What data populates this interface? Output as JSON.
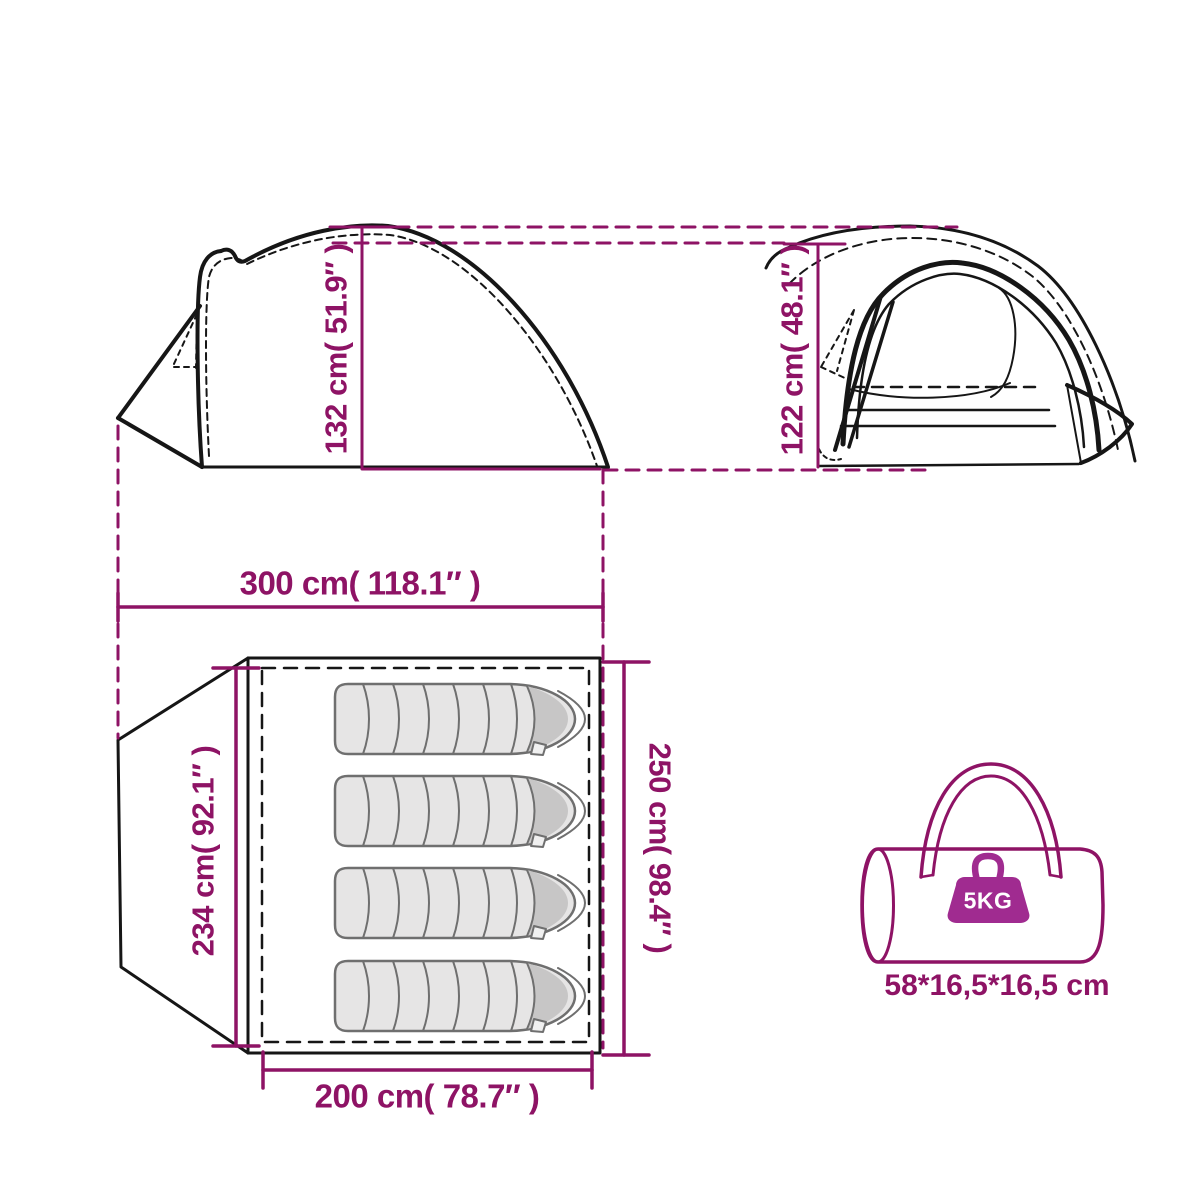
{
  "diagram": {
    "type": "tent-dimension-diagram",
    "colors": {
      "accent_magenta": "#8E1365",
      "weight_badge": "#A02B90",
      "line_black": "#161616",
      "sleeping_bag_fill": "#E6E5E5",
      "sleeping_bag_cap": "#C7C6C6",
      "sleeping_bag_outline": "#6F6F6F"
    },
    "views": {
      "side": {
        "height_label": "132 cm( 51.9″ )"
      },
      "front": {
        "height_label": "122 cm( 48.1″ )"
      },
      "footprint": {
        "width_label": "300 cm( 118.1″ )",
        "depth_label": "234 cm( 92.1″ )",
        "inner_length_label": "250 cm( 98.4″ )",
        "inner_width_label": "200 cm( 78.7″ )",
        "sleeping_bag_count": 4
      },
      "carry_bag": {
        "weight_label": "5KG",
        "size_label": "58*16,5*16,5 cm"
      }
    }
  }
}
